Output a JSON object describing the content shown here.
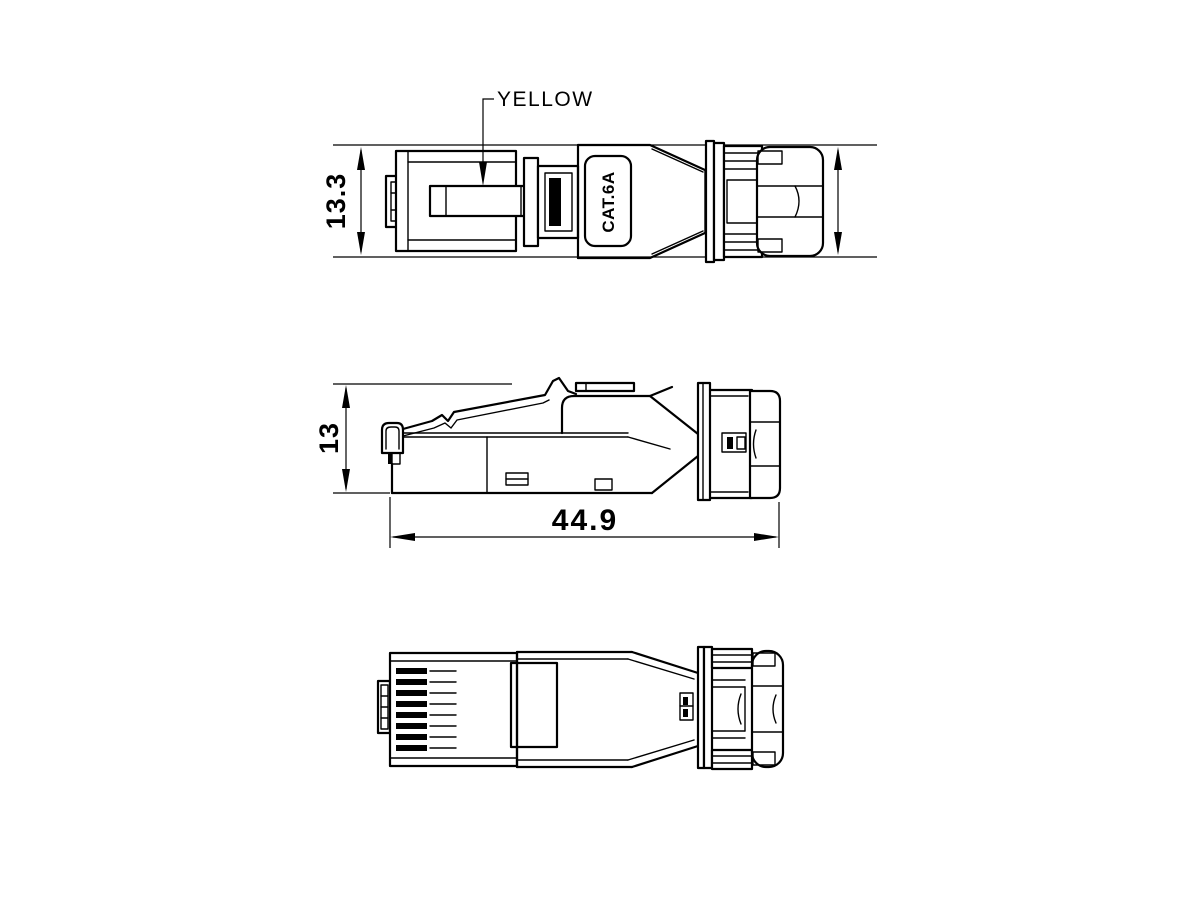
{
  "callout": {
    "label": "YELLOW"
  },
  "marking": {
    "label": "CAT.6A"
  },
  "dimensions": {
    "plug_height": "13.3",
    "boot_height": "13.6",
    "front_height": "13",
    "total_length": "44.9"
  },
  "colors": {
    "line": "#000000",
    "background": "#ffffff"
  }
}
